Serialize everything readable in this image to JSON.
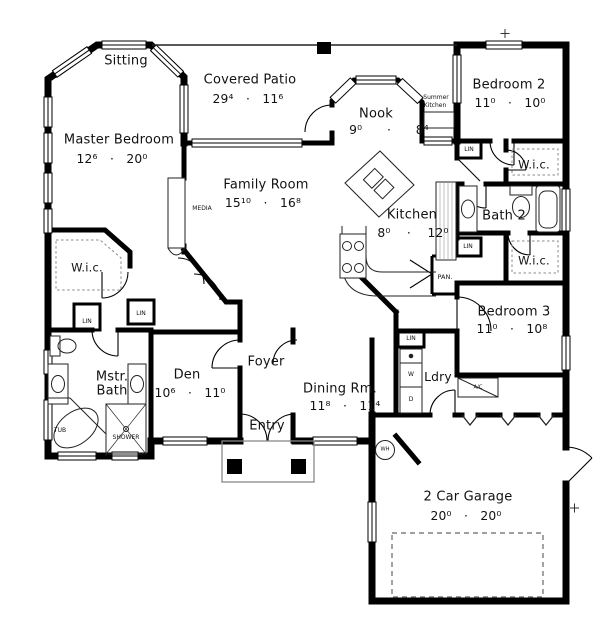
{
  "plan": {
    "rooms": {
      "sitting": {
        "label": "Sitting"
      },
      "covered_patio": {
        "label": "Covered Patio",
        "dims": "29⁴   ·   11⁶"
      },
      "master_bedroom": {
        "label": "Master Bedroom",
        "dims": "12⁶   ·   20⁰"
      },
      "family_room": {
        "label": "Family Room",
        "dims": "15¹⁰   ·   16⁸"
      },
      "nook": {
        "label": "Nook",
        "dims": "9⁰      ·      8⁴"
      },
      "kitchen": {
        "label": "Kitchen",
        "dims": "8⁰    ·    12⁰"
      },
      "bedroom2": {
        "label": "Bedroom 2",
        "dims": "11⁰   ·   10⁰"
      },
      "bath2": {
        "label": "Bath 2"
      },
      "wic": {
        "label": "W.i.c."
      },
      "bedroom3": {
        "label": "Bedroom 3",
        "dims": "11⁰   ·   10⁸"
      },
      "master_bath": {
        "label_line1": "Mstr.",
        "label_line2": "Bath"
      },
      "den": {
        "label": "Den",
        "dims": "10⁶   ·   11⁰"
      },
      "foyer": {
        "label": "Foyer"
      },
      "dining": {
        "label": "Dining Rm.",
        "dims": "11⁸   ·   11⁴"
      },
      "entry": {
        "label": "Entry"
      },
      "laundry": {
        "label": "Ldry"
      },
      "garage": {
        "label": "2 Car Garage",
        "dims": "20⁰   ·   20⁰"
      }
    },
    "fixtures": {
      "summer_kitchen_line1": "Summer",
      "summer_kitchen_line2": "Kitchen",
      "linen": "LIN",
      "pantry": "PAN.",
      "media": "MEDIA",
      "washer": "W",
      "dryer": "D",
      "water_heater": "WH",
      "ac": "A/C",
      "tub": "TUB",
      "shower": "SHOWER"
    },
    "colors": {
      "wall": "#000000",
      "background": "#ffffff",
      "thin_line": "#333333"
    }
  }
}
